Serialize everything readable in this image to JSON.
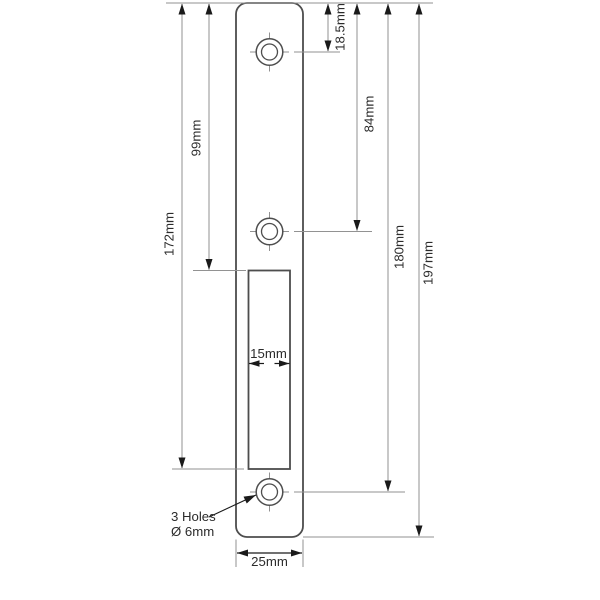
{
  "colors": {
    "background": "#ffffff",
    "outline": "#4d4d4d",
    "dim_line": "#929292",
    "arrow": "#1a1a1a",
    "text": "#2b2b2b"
  },
  "drawing": {
    "canvas": {
      "width": 600,
      "height": 600
    },
    "units": "mm",
    "plate": {
      "x": 236,
      "y": 3,
      "width": 67,
      "height": 534,
      "corner_radius": 11,
      "width_mm": 25,
      "height_mm": 197
    },
    "cutout": {
      "x": 248.5,
      "y": 270.5,
      "width": 41.5,
      "height": 198.5,
      "width_mm": 15
    },
    "holes": {
      "outer_radius": 13.3,
      "inner_radius": 8,
      "crosshair_extent": 19.5,
      "cx": 269.5,
      "centers": [
        {
          "name": "hole-top",
          "cy": 52,
          "from_top_mm": 18.5
        },
        {
          "name": "hole-middle",
          "cy": 231.5,
          "from_top_mm": 84
        },
        {
          "name": "hole-bottom",
          "cy": 492,
          "from_top_mm": 180
        }
      ]
    },
    "vertical_dimensions": [
      {
        "name": "dim-172mm",
        "label": "172mm",
        "value_mm": 172,
        "x": 182,
        "y1": 3,
        "y2": 469,
        "label_x": 169,
        "label_y": 234
      },
      {
        "name": "dim-99mm",
        "label": "99mm",
        "value_mm": 99,
        "x": 209,
        "y1": 3,
        "y2": 270.5,
        "label_x": 196,
        "label_y": 138
      },
      {
        "name": "dim-18p5mm",
        "label": "18.5mm",
        "value_mm": 18.5,
        "x": 328,
        "y1": 3,
        "y2": 52,
        "label_x": 340,
        "label_y": 27
      },
      {
        "name": "dim-84mm",
        "label": "84mm",
        "value_mm": 84,
        "x": 357,
        "y1": 3,
        "y2": 231.5,
        "label_x": 369,
        "label_y": 114
      },
      {
        "name": "dim-180mm",
        "label": "180mm",
        "value_mm": 180,
        "x": 388,
        "y1": 3,
        "y2": 492,
        "label_x": 399,
        "label_y": 247
      },
      {
        "name": "dim-197mm",
        "label": "197mm",
        "value_mm": 197,
        "x": 419,
        "y1": 3,
        "y2": 537,
        "label_x": 428,
        "label_y": 263
      }
    ],
    "width_dimension": {
      "name": "dim-25mm",
      "label": "25mm",
      "value_mm": 25,
      "y": 553,
      "x1": 237,
      "x2": 302,
      "label_x": 269.5,
      "label_y": 566
    },
    "slot_dimension": {
      "name": "dim-15mm",
      "label": "15mm",
      "value_mm": 15,
      "y": 363.5,
      "x1": 249,
      "x2": 289.5,
      "tail": 15,
      "label_x": 268.5,
      "label_y": 358
    },
    "extension_lines": [
      {
        "name": "ext-top-edge",
        "x1": 166,
        "y1": 3,
        "x2": 433,
        "y2": 3
      },
      {
        "name": "ext-hole-top",
        "x1": 294,
        "y1": 52,
        "x2": 340,
        "y2": 52
      },
      {
        "name": "ext-hole-middle",
        "x1": 294,
        "y1": 231.5,
        "x2": 372,
        "y2": 231.5
      },
      {
        "name": "ext-cutout-top",
        "x1": 193,
        "y1": 270.5,
        "x2": 246,
        "y2": 270.5
      },
      {
        "name": "ext-cutout-bottom",
        "x1": 172,
        "y1": 469,
        "x2": 244,
        "y2": 469
      },
      {
        "name": "ext-hole-bottom",
        "x1": 294,
        "y1": 492,
        "x2": 405,
        "y2": 492
      },
      {
        "name": "ext-plate-bottom",
        "x1": 303,
        "y1": 537,
        "x2": 434,
        "y2": 537
      },
      {
        "name": "ext-width-left",
        "x1": 236,
        "y1": 539.5,
        "x2": 236,
        "y2": 567
      },
      {
        "name": "ext-width-right",
        "x1": 303,
        "y1": 539.5,
        "x2": 303,
        "y2": 567
      }
    ],
    "leader": {
      "name": "leader-3-holes",
      "x1": 209,
      "y1": 517,
      "x2": 256,
      "y2": 495
    },
    "note": {
      "line1": "3 Holes",
      "line2": "Ø 6mm",
      "x": 171,
      "y1": 521,
      "y2": 536,
      "font_size": 13.2
    },
    "label_font_size": 13.2
  }
}
